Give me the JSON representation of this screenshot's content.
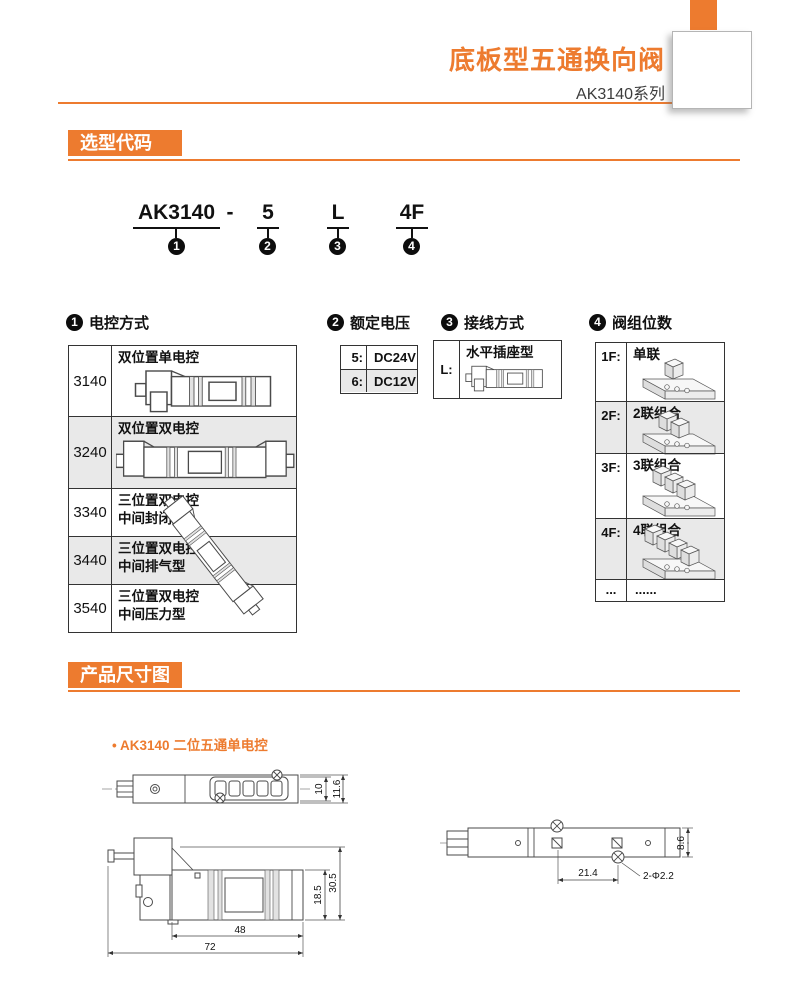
{
  "header": {
    "title": "底板型五通换向阀",
    "series": "AK3140系列"
  },
  "sections": {
    "selection": {
      "title": "选型代码"
    },
    "dimensions": {
      "title": "产品尺寸图",
      "bullet_dot": "•",
      "bullet": "AK3140 二位五通单电控"
    }
  },
  "model": {
    "p1": "AK3140",
    "dash": "-",
    "p2": "5",
    "p3": "L",
    "p4": "4F",
    "n1": "1",
    "n2": "2",
    "n3": "3",
    "n4": "4"
  },
  "groups": {
    "g1": {
      "num": "1",
      "title": "电控方式",
      "rows": [
        {
          "code": "3140",
          "l1": "双位置单电控",
          "l2": ""
        },
        {
          "code": "3240",
          "l1": "双位置双电控",
          "l2": ""
        },
        {
          "code": "3340",
          "l1": "三位置双电控",
          "l2": "中间封闭型"
        },
        {
          "code": "3440",
          "l1": "三位置双电控",
          "l2": "中间排气型"
        },
        {
          "code": "3540",
          "l1": "三位置双电控",
          "l2": "中间压力型"
        }
      ]
    },
    "g2": {
      "num": "2",
      "title": "额定电压",
      "rows": [
        {
          "code": "5:",
          "label": "DC24V"
        },
        {
          "code": "6:",
          "label": "DC12V"
        }
      ]
    },
    "g3": {
      "num": "3",
      "title": "接线方式",
      "rows": [
        {
          "code": "L:",
          "label": "水平插座型"
        }
      ]
    },
    "g4": {
      "num": "4",
      "title": "阀组位数",
      "rows": [
        {
          "code": "1F:",
          "label": "单联"
        },
        {
          "code": "2F:",
          "label": "2联组合"
        },
        {
          "code": "3F:",
          "label": "3联组合"
        },
        {
          "code": "4F:",
          "label": "4联组合"
        },
        {
          "code": "...",
          "label": "......"
        }
      ]
    }
  },
  "dims": {
    "d10": "10",
    "d11_6": "11.6",
    "d18_5": "18.5",
    "d30_5": "30.5",
    "d48": "48",
    "d72": "72",
    "d21_4": "21.4",
    "d2_2": "2-Φ2.2",
    "d8_6": "8.6"
  },
  "colors": {
    "accent": "#ED7B2F",
    "row_alt": "#E9E9E9"
  }
}
